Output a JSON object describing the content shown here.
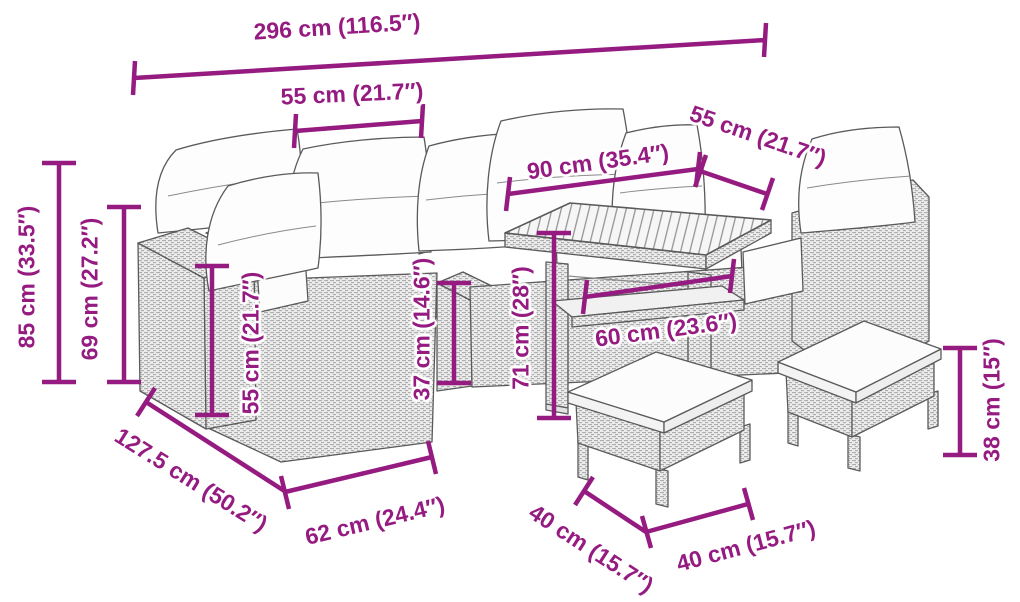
{
  "diagram": {
    "type": "product-dimension-diagram",
    "subject": "rattan garden lounge set with table and stools",
    "accent_color": "#951b81",
    "line_color": "#555555"
  },
  "dimensions": {
    "overall_width": {
      "label": "296 cm (116.5″)",
      "cm": 296,
      "inches": 116.5
    },
    "section_width": {
      "label": "55 cm (21.7″)",
      "cm": 55,
      "inches": 21.7
    },
    "table_width": {
      "label": "90 cm (35.4″)",
      "cm": 90,
      "inches": 35.4
    },
    "section_depth": {
      "label": "55 cm (21.7″)",
      "cm": 55,
      "inches": 21.7
    },
    "total_height": {
      "label": "85 cm (33.5″)",
      "cm": 85,
      "inches": 33.5
    },
    "back_height": {
      "label": "69 cm (27.2″)",
      "cm": 69,
      "inches": 27.2
    },
    "armrest_height": {
      "label": "55 cm (21.7″)",
      "cm": 55,
      "inches": 21.7
    },
    "low_armrest_height": {
      "label": "37 cm (14.6″)",
      "cm": 37,
      "inches": 14.6
    },
    "table_height": {
      "label": "71 cm (28″)",
      "cm": 71,
      "inches": 28
    },
    "shelf_width": {
      "label": "60 cm (23.6″)",
      "cm": 60,
      "inches": 23.6
    },
    "total_depth": {
      "label": "127.5 cm (50.2″)",
      "cm": 127.5,
      "inches": 50.2
    },
    "seat_depth": {
      "label": "62 cm (24.4″)",
      "cm": 62,
      "inches": 24.4
    },
    "stool_depth": {
      "label": "40 cm (15.7″)",
      "cm": 40,
      "inches": 15.7
    },
    "stool_width": {
      "label": "40 cm (15.7″)",
      "cm": 40,
      "inches": 15.7
    },
    "stool_height": {
      "label": "38 cm (15″)",
      "cm": 38,
      "inches": 15
    }
  }
}
